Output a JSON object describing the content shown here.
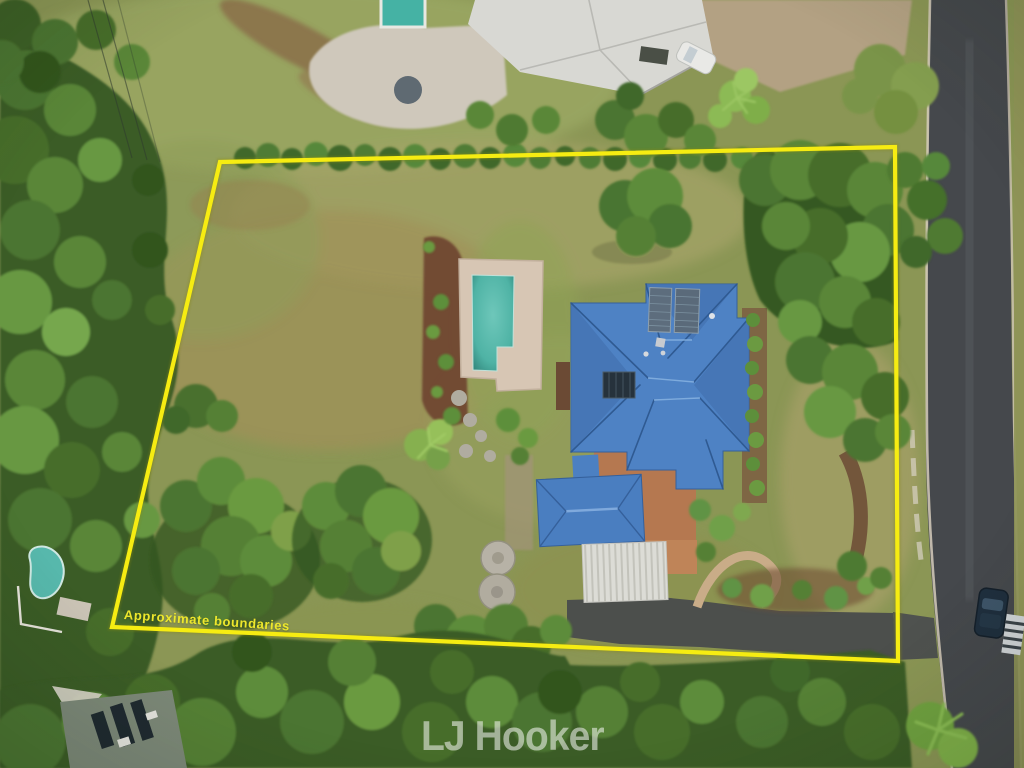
{
  "overlay": {
    "boundary_label": "Approximate boundaries",
    "boundary_color": "#f6ec12",
    "label_color": "#ede72c"
  },
  "watermark": {
    "text": "LJ Hooker",
    "color": "rgba(240,242,236,0.58)"
  },
  "scene_colors": {
    "lawn_green": "#8b9655",
    "tree_green": "#4c7430",
    "main_roof_blue": "#4e82c4",
    "garage_roof_blue": "#4a7ec0",
    "pool_teal": "#4fb3a5",
    "road_asphalt": "#45484c",
    "driveway_asphalt": "#4c4f4c",
    "brick_paving": "#b57850",
    "carport_white": "#dcdcd6"
  }
}
